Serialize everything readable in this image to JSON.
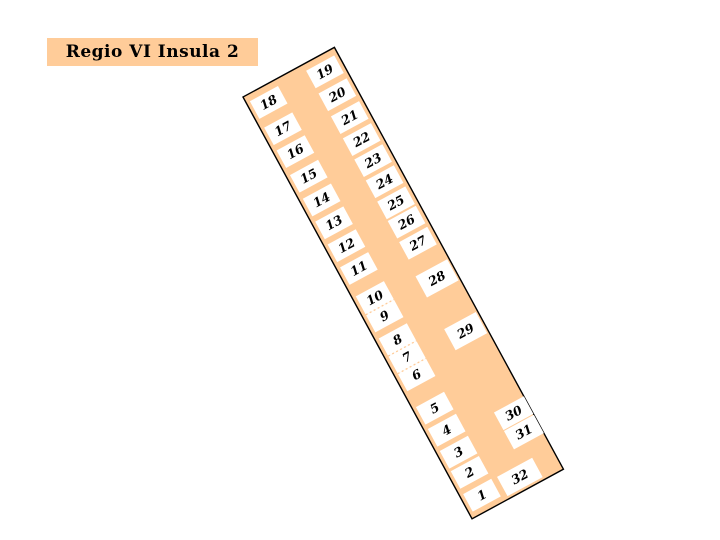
{
  "title": "Regio VI Insula 2",
  "colors": {
    "background": "#FFFFFF",
    "insula_fill": "#FFCC99",
    "outline": "#000000",
    "plot_fill": "#FFFFFF",
    "plot_text": "#000000",
    "title_bg": "#FFCC99",
    "title_text": "#000000",
    "divider": "#FFCC99"
  },
  "insula": {
    "origin_x": 243,
    "origin_y": 97,
    "rotation_deg": -28.5,
    "width": 104,
    "height": 480,
    "plots": [
      {
        "label": "1",
        "x": 4,
        "y": 454,
        "w": 32,
        "h": 20
      },
      {
        "label": "2",
        "x": 4,
        "y": 428,
        "w": 32,
        "h": 20
      },
      {
        "label": "3",
        "x": 4,
        "y": 405,
        "w": 32,
        "h": 20
      },
      {
        "label": "4",
        "x": 4,
        "y": 380,
        "w": 32,
        "h": 20
      },
      {
        "label": "5",
        "x": 4,
        "y": 355,
        "w": 32,
        "h": 20
      },
      {
        "label": "6",
        "x": 4,
        "y": 317,
        "w": 32,
        "h": 20
      },
      {
        "label": "7",
        "x": 4,
        "y": 297,
        "w": 32,
        "h": 20
      },
      {
        "label": "8",
        "x": 4,
        "y": 277,
        "w": 32,
        "h": 20
      },
      {
        "label": "9",
        "x": 4,
        "y": 250,
        "w": 32,
        "h": 20
      },
      {
        "label": "10",
        "x": 4,
        "y": 229,
        "w": 32,
        "h": 21
      },
      {
        "label": "11",
        "x": 4,
        "y": 196,
        "w": 32,
        "h": 20
      },
      {
        "label": "12",
        "x": 4,
        "y": 170,
        "w": 32,
        "h": 20
      },
      {
        "label": "13",
        "x": 4,
        "y": 144,
        "w": 32,
        "h": 20
      },
      {
        "label": "14",
        "x": 4,
        "y": 118,
        "w": 32,
        "h": 20
      },
      {
        "label": "15",
        "x": 4,
        "y": 91,
        "w": 32,
        "h": 20
      },
      {
        "label": "16",
        "x": 4,
        "y": 63,
        "w": 32,
        "h": 20
      },
      {
        "label": "17",
        "x": 4,
        "y": 37,
        "w": 32,
        "h": 20
      },
      {
        "label": "18",
        "x": 4,
        "y": 7,
        "w": 32,
        "h": 20
      },
      {
        "label": "19",
        "x": 68,
        "y": 7,
        "w": 32,
        "h": 20
      },
      {
        "label": "20",
        "x": 68,
        "y": 33,
        "w": 32,
        "h": 20
      },
      {
        "label": "21",
        "x": 68,
        "y": 59,
        "w": 32,
        "h": 20
      },
      {
        "label": "22",
        "x": 68,
        "y": 84,
        "w": 32,
        "h": 20
      },
      {
        "label": "23",
        "x": 68,
        "y": 108,
        "w": 32,
        "h": 20
      },
      {
        "label": "24",
        "x": 68,
        "y": 132,
        "w": 32,
        "h": 20
      },
      {
        "label": "25",
        "x": 68,
        "y": 156,
        "w": 32,
        "h": 20
      },
      {
        "label": "26",
        "x": 68,
        "y": 178,
        "w": 32,
        "h": 20
      },
      {
        "label": "27",
        "x": 68,
        "y": 202,
        "w": 32,
        "h": 20
      },
      {
        "label": "28",
        "x": 66,
        "y": 240,
        "w": 36,
        "h": 24
      },
      {
        "label": "29",
        "x": 66,
        "y": 300,
        "w": 36,
        "h": 24
      },
      {
        "label": "30",
        "x": 70,
        "y": 397,
        "w": 34,
        "h": 20
      },
      {
        "label": "31",
        "x": 70,
        "y": 418,
        "w": 34,
        "h": 21
      },
      {
        "label": "32",
        "x": 42,
        "y": 455,
        "w": 40,
        "h": 22
      }
    ],
    "dividers": [
      {
        "x1": 4,
        "y1": 250,
        "x2": 36,
        "y2": 250
      },
      {
        "x1": 4,
        "y1": 297,
        "x2": 36,
        "y2": 297
      },
      {
        "x1": 4,
        "y1": 317,
        "x2": 36,
        "y2": 317
      }
    ]
  }
}
